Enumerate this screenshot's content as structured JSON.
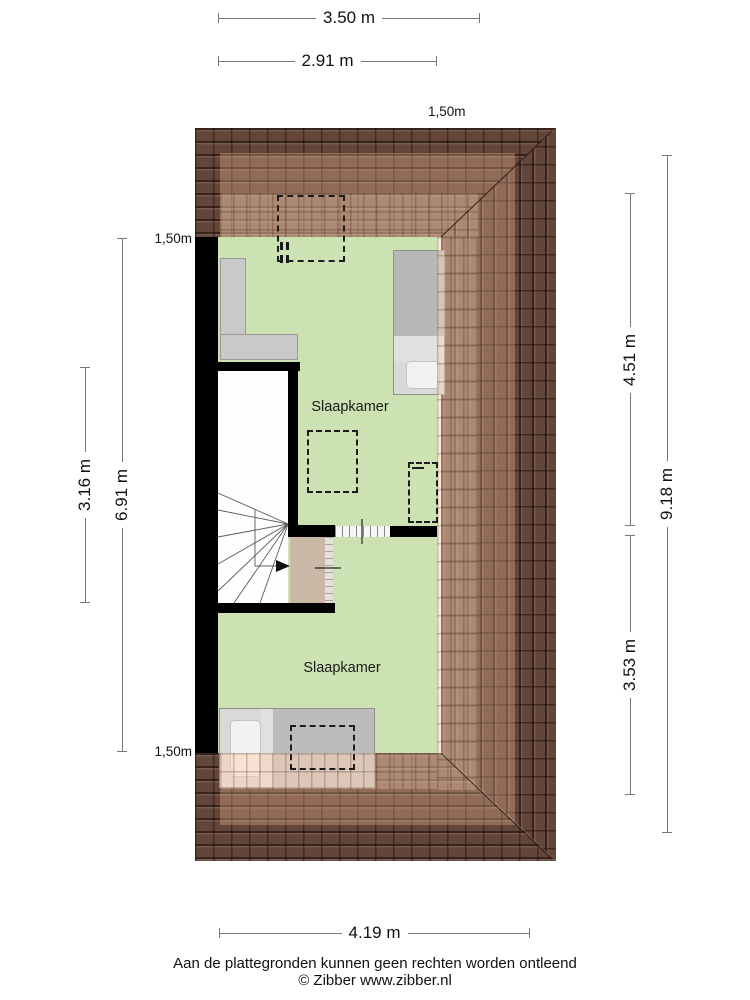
{
  "floorplan": {
    "rooms": [
      {
        "label": "Slaapkamer"
      },
      {
        "label": "Slaapkamer"
      }
    ],
    "markers": {
      "top": "1,50m",
      "left_upper": "1,50m",
      "left_lower": "1,50m"
    },
    "dimensions": {
      "top_outer": "3.50 m",
      "top_inner": "2.91 m",
      "left_inner": "3.16 m",
      "left_outer": "6.91 m",
      "right_upper": "4.51 m",
      "right_lower": "3.53 m",
      "right_outer": "9.18 m",
      "bottom": "4.19 m"
    },
    "footer": {
      "disclaimer": "Aan de plattegronden kunnen geen rechten worden ontleend",
      "copyright": "© Zibber www.zibber.nl"
    },
    "colors": {
      "roof": "#63453a",
      "floor": "#cde2b2",
      "wall": "#000000",
      "door": "#c9b8a6"
    }
  }
}
